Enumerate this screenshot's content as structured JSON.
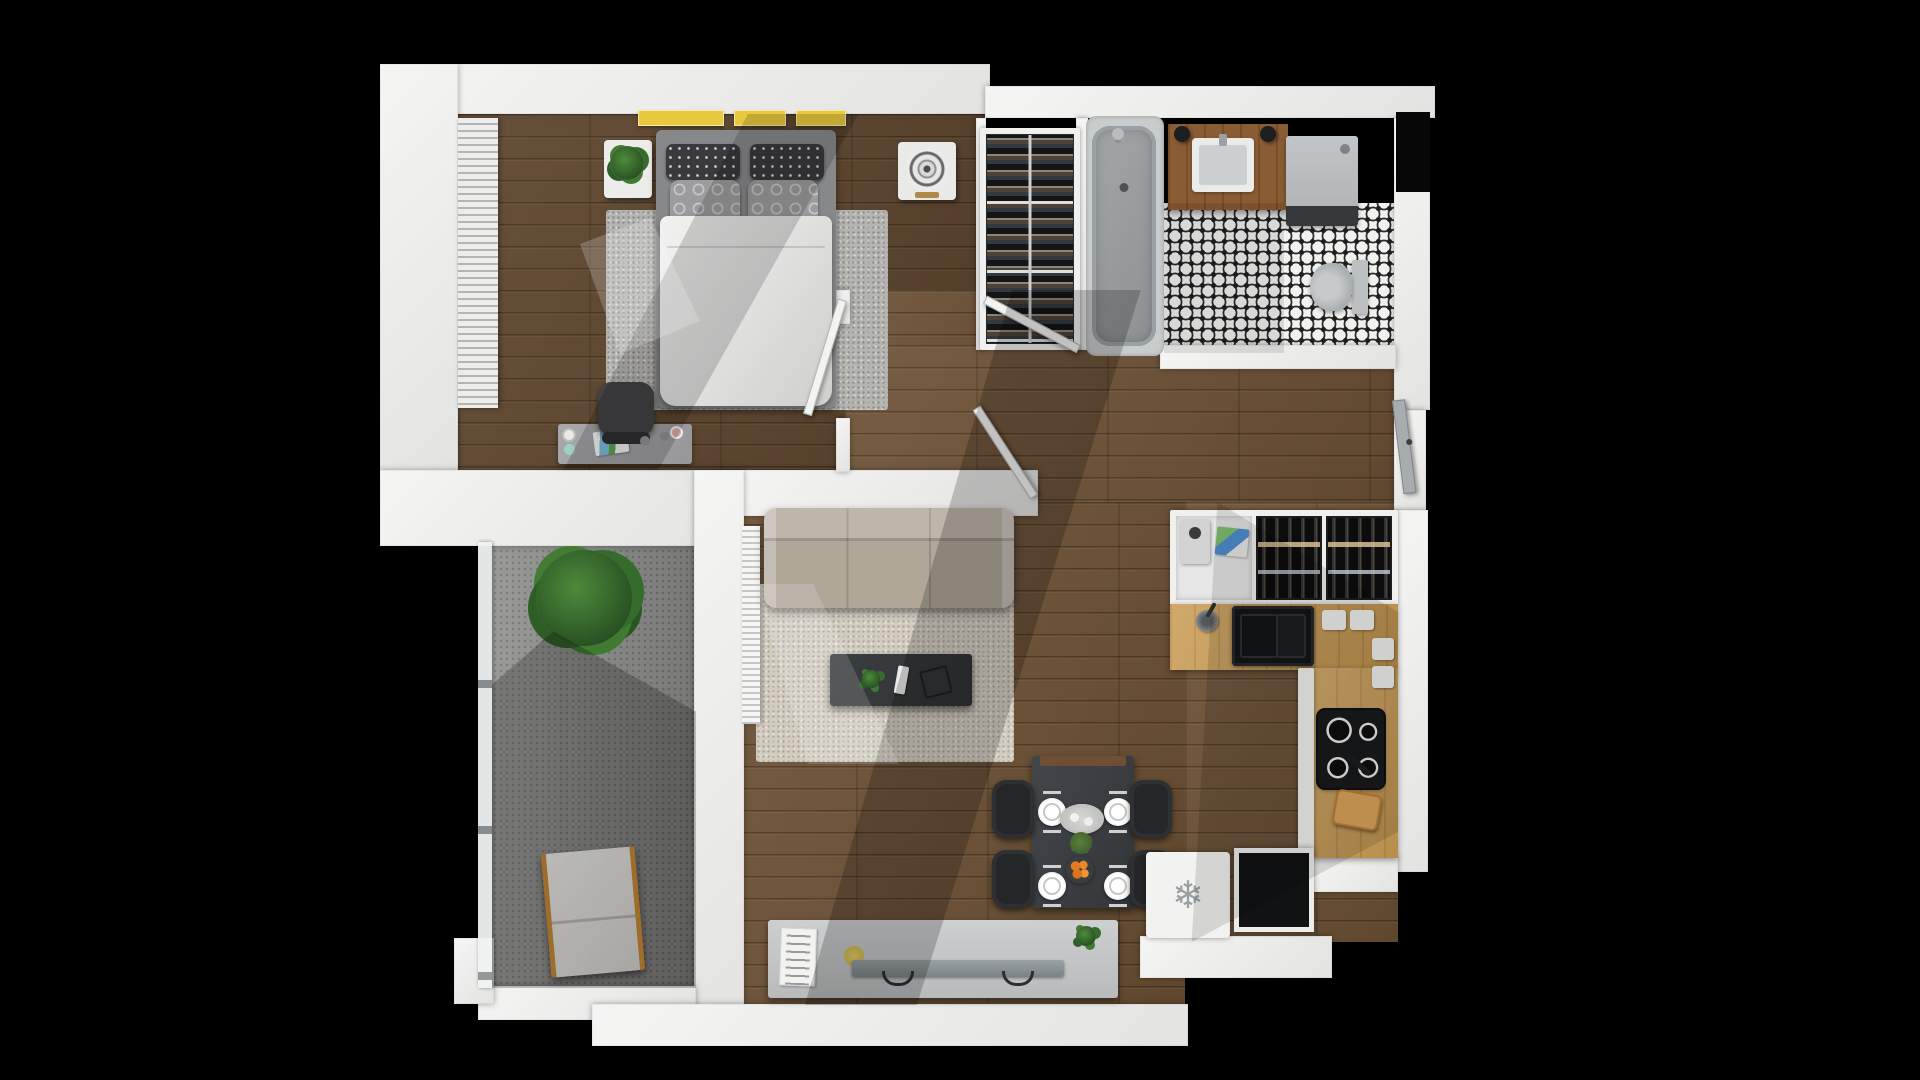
{
  "meta": {
    "title": "One-bedroom apartment 3D floor plan (top-down render)",
    "background": "#000000",
    "rooms": [
      "bedroom",
      "wardrobe-closet",
      "bathroom",
      "hallway",
      "kitchen",
      "living-room",
      "dining-area",
      "balcony"
    ]
  },
  "palette": {
    "wall": "#ececeb",
    "wood_floor": "#6d5135",
    "bedroom_floor": "#5c442c",
    "bedroom_rug": "#b5b4b1",
    "living_rug": "#d3cdc0",
    "sofa": "#aba293",
    "counter_oak": "#c89a52",
    "tile_white": "#f1f1ef",
    "tile_black": "#1f1f1f",
    "accent_yellow_books": "#e7c83e",
    "orange_fruit": "#e07b1f",
    "plant_green": "#2e5a26",
    "balcony_concrete": "#8f8f8d",
    "appliance_dark": "#111214"
  },
  "icons": {
    "freezer_snowflake": "❄"
  },
  "elements": [
    {
      "name": "floor-bedroom",
      "kind": "wood-dark",
      "x": 458,
      "y": 114,
      "w": 527,
      "h": 356
    },
    {
      "name": "floor-hall-upper",
      "kind": "wood",
      "x": 845,
      "y": 290,
      "w": 240,
      "h": 60
    },
    {
      "name": "floor-hallway",
      "kind": "wood",
      "x": 845,
      "y": 345,
      "w": 553,
      "h": 160
    },
    {
      "name": "floor-living",
      "kind": "wood",
      "x": 725,
      "y": 502,
      "w": 460,
      "h": 503
    },
    {
      "name": "floor-kitchen",
      "kind": "wood",
      "x": 1185,
      "y": 502,
      "w": 213,
      "h": 440
    },
    {
      "name": "floor-bathroom-tile",
      "kind": "tile",
      "x": 1164,
      "y": 203,
      "w": 232,
      "h": 150
    },
    {
      "name": "floor-balcony",
      "kind": "concrete",
      "x": 492,
      "y": 542,
      "w": 204,
      "h": 446
    },
    {
      "name": "rug-bedroom",
      "kind": "rug-grey",
      "x": 606,
      "y": 210,
      "w": 282,
      "h": 200
    },
    {
      "name": "rug-living",
      "kind": "rug-cream",
      "x": 756,
      "y": 584,
      "w": 258,
      "h": 178
    },
    {
      "name": "wall-top-left",
      "kind": "wall",
      "x": 380,
      "y": 64,
      "w": 610,
      "h": 50
    },
    {
      "name": "wall-left-bedroom",
      "kind": "wall",
      "x": 380,
      "y": 64,
      "w": 78,
      "h": 408
    },
    {
      "name": "wall-top-right",
      "kind": "wall",
      "x": 985,
      "y": 86,
      "w": 450,
      "h": 32
    },
    {
      "name": "wall-right-upper",
      "kind": "wall",
      "x": 1394,
      "y": 118,
      "w": 36,
      "h": 292
    },
    {
      "name": "shaft-niche",
      "kind": "black-box",
      "x": 1396,
      "y": 112,
      "w": 34,
      "h": 80
    },
    {
      "name": "wall-right-entry",
      "kind": "wall",
      "x": 1394,
      "y": 410,
      "w": 32,
      "h": 100
    },
    {
      "name": "wall-right-kitchen",
      "kind": "wall",
      "x": 1396,
      "y": 510,
      "w": 32,
      "h": 362
    },
    {
      "name": "wall-closet-left",
      "kind": "wall",
      "x": 976,
      "y": 118,
      "w": 10,
      "h": 232
    },
    {
      "name": "wall-closet-right",
      "kind": "wall",
      "x": 1076,
      "y": 118,
      "w": 12,
      "h": 232
    },
    {
      "name": "wall-bedroom-bottom",
      "kind": "wall",
      "x": 380,
      "y": 470,
      "w": 346,
      "h": 76
    },
    {
      "name": "wall-living-top",
      "kind": "wall",
      "x": 726,
      "y": 470,
      "w": 312,
      "h": 46
    },
    {
      "name": "wall-stub-bedroom-door",
      "kind": "wall",
      "x": 836,
      "y": 290,
      "w": 14,
      "h": 34
    },
    {
      "name": "wall-stub-bedroom-door-lower",
      "kind": "wall",
      "x": 836,
      "y": 418,
      "w": 14,
      "h": 54
    },
    {
      "name": "wall-bathroom-bottom",
      "kind": "wall",
      "x": 1160,
      "y": 345,
      "w": 236,
      "h": 24
    },
    {
      "name": "wall-balcony-divider",
      "kind": "wall",
      "x": 694,
      "y": 470,
      "w": 50,
      "h": 550
    },
    {
      "name": "wall-balcony-bottom",
      "kind": "wall",
      "x": 478,
      "y": 986,
      "w": 218,
      "h": 34
    },
    {
      "name": "wall-living-bottom",
      "kind": "wall",
      "x": 592,
      "y": 1004,
      "w": 596,
      "h": 42
    },
    {
      "name": "wall-bottom-right-step",
      "kind": "wall",
      "x": 1140,
      "y": 936,
      "w": 192,
      "h": 42
    },
    {
      "name": "wall-bottom-right-corner",
      "kind": "wall",
      "x": 1314,
      "y": 856,
      "w": 84,
      "h": 36
    },
    {
      "name": "wall-balcony-sill",
      "kind": "wall",
      "x": 454,
      "y": 938,
      "w": 40,
      "h": 66
    },
    {
      "name": "window-blinds-bedroom",
      "kind": "blinds",
      "x": 458,
      "y": 118,
      "w": 40,
      "h": 290
    },
    {
      "name": "nightstand-left",
      "kind": "nightstand",
      "x": 604,
      "y": 140,
      "w": 48,
      "h": 58
    },
    {
      "name": "nightstand-plant",
      "kind": "plant",
      "x": 610,
      "y": 146,
      "w": 34,
      "h": 34
    },
    {
      "name": "shelf-books-1",
      "kind": "book-yellow",
      "x": 638,
      "y": 110,
      "w": 86,
      "h": 16
    },
    {
      "name": "shelf-books-2",
      "kind": "book-yellow",
      "x": 734,
      "y": 110,
      "w": 52,
      "h": 16
    },
    {
      "name": "shelf-books-3",
      "kind": "book-yellow",
      "x": 796,
      "y": 110,
      "w": 50,
      "h": 16
    },
    {
      "name": "bed-frame",
      "kind": "bed-frame",
      "x": 656,
      "y": 130,
      "w": 180,
      "h": 278
    },
    {
      "name": "pillow-dark-left",
      "kind": "pillow-dark",
      "x": 666,
      "y": 144,
      "w": 74,
      "h": 36
    },
    {
      "name": "pillow-dark-right",
      "kind": "pillow-dark",
      "x": 750,
      "y": 144,
      "w": 74,
      "h": 36
    },
    {
      "name": "pillow-grey-left",
      "kind": "pillow-grey",
      "x": 670,
      "y": 180,
      "w": 70,
      "h": 46
    },
    {
      "name": "pillow-grey-right",
      "kind": "pillow-grey",
      "x": 748,
      "y": 180,
      "w": 70,
      "h": 46
    },
    {
      "name": "bed-duvet",
      "kind": "duvet",
      "x": 660,
      "y": 216,
      "w": 172,
      "h": 190
    },
    {
      "name": "nightstand-fan",
      "kind": "fan-unit",
      "x": 898,
      "y": 142,
      "w": 58,
      "h": 58
    },
    {
      "name": "desk",
      "kind": "desk",
      "x": 558,
      "y": 424,
      "w": 134,
      "h": 40
    },
    {
      "name": "desk-papers",
      "kind": "desk-papers",
      "x": 594,
      "y": 430,
      "w": 34,
      "h": 24,
      "r": -8
    },
    {
      "name": "office-chair",
      "kind": "chair-office",
      "x": 598,
      "y": 382,
      "w": 56,
      "h": 54
    },
    {
      "name": "desk-knob-1",
      "kind": "knob",
      "x": 640,
      "y": 436,
      "w": 10,
      "h": 10
    },
    {
      "name": "desk-knob-2",
      "kind": "knob",
      "x": 660,
      "y": 432,
      "w": 9,
      "h": 9
    },
    {
      "name": "desk-knob-3",
      "kind": "knob-pink",
      "x": 672,
      "y": 428,
      "w": 9,
      "h": 9
    },
    {
      "name": "desk-disc-1",
      "kind": "disc-white",
      "x": 562,
      "y": 428,
      "w": 14,
      "h": 14
    },
    {
      "name": "desk-disc-2",
      "kind": "disc-teal",
      "x": 564,
      "y": 444,
      "w": 11,
      "h": 11
    },
    {
      "name": "wardrobe-frame",
      "kind": "frame-white",
      "x": 980,
      "y": 128,
      "w": 100,
      "h": 222
    },
    {
      "name": "wardrobe-rack",
      "kind": "closet-rack",
      "x": 986,
      "y": 134,
      "w": 88,
      "h": 210
    },
    {
      "name": "bathtub-surround",
      "kind": "tub-surround",
      "x": 1086,
      "y": 116,
      "w": 78,
      "h": 240
    },
    {
      "name": "bathtub",
      "kind": "tub",
      "x": 1092,
      "y": 126,
      "w": 64,
      "h": 220
    },
    {
      "name": "bath-faucet",
      "kind": "faucet-dot",
      "x": 1112,
      "y": 128,
      "w": 12,
      "h": 12
    },
    {
      "name": "vanity",
      "kind": "vanity-wood",
      "x": 1168,
      "y": 124,
      "w": 120,
      "h": 86
    },
    {
      "name": "bath-sink",
      "kind": "sink-white",
      "x": 1192,
      "y": 138,
      "w": 62,
      "h": 54
    },
    {
      "name": "sconce-left",
      "kind": "sconce",
      "x": 1174,
      "y": 126,
      "w": 16,
      "h": 16
    },
    {
      "name": "sconce-right",
      "kind": "sconce",
      "x": 1260,
      "y": 126,
      "w": 16,
      "h": 16
    },
    {
      "name": "washer",
      "kind": "washer",
      "x": 1286,
      "y": 136,
      "w": 72,
      "h": 90
    },
    {
      "name": "toilet",
      "kind": "toilet",
      "x": 1310,
      "y": 260,
      "w": 58,
      "h": 54
    },
    {
      "name": "kitchen-upper-unit",
      "kind": "frame-white",
      "x": 1170,
      "y": 510,
      "w": 228,
      "h": 96
    },
    {
      "name": "appliance-nook",
      "kind": "appliance-nook",
      "x": 1176,
      "y": 516,
      "w": 76,
      "h": 84
    },
    {
      "name": "espresso-machine",
      "kind": "espresso",
      "x": 1180,
      "y": 520,
      "w": 30,
      "h": 44
    },
    {
      "name": "recipe-card",
      "kind": "card-color",
      "x": 1216,
      "y": 528,
      "w": 32,
      "h": 28,
      "r": 6
    },
    {
      "name": "wine-rack-left",
      "kind": "wine-rack",
      "x": 1256,
      "y": 516,
      "w": 66,
      "h": 84
    },
    {
      "name": "wine-rack-right",
      "kind": "wine-rack",
      "x": 1326,
      "y": 516,
      "w": 66,
      "h": 84
    },
    {
      "name": "counter-sink-run",
      "kind": "counter-oak",
      "x": 1170,
      "y": 604,
      "w": 228,
      "h": 66
    },
    {
      "name": "kitchen-faucet",
      "kind": "faucet-kitchen",
      "x": 1196,
      "y": 610,
      "w": 22,
      "h": 22
    },
    {
      "name": "kitchen-sink",
      "kind": "sink-black",
      "x": 1232,
      "y": 606,
      "w": 82,
      "h": 60
    },
    {
      "name": "trivet-1",
      "kind": "trivet",
      "x": 1322,
      "y": 610,
      "w": 24,
      "h": 20
    },
    {
      "name": "trivet-2",
      "kind": "trivet",
      "x": 1350,
      "y": 610,
      "w": 24,
      "h": 20
    },
    {
      "name": "counter-right-run",
      "kind": "counter-oak",
      "x": 1312,
      "y": 668,
      "w": 86,
      "h": 190
    },
    {
      "name": "cabinet-strip",
      "kind": "frame-white",
      "x": 1298,
      "y": 668,
      "w": 16,
      "h": 190
    },
    {
      "name": "trivet-3",
      "kind": "trivet",
      "x": 1372,
      "y": 638,
      "w": 22,
      "h": 22
    },
    {
      "name": "trivet-4",
      "kind": "trivet",
      "x": 1372,
      "y": 666,
      "w": 22,
      "h": 22
    },
    {
      "name": "cooktop",
      "kind": "cooktop",
      "x": 1318,
      "y": 710,
      "w": 66,
      "h": 78
    },
    {
      "name": "pan-handle",
      "kind": "pan-handle",
      "x": 1344,
      "y": 762,
      "w": 30,
      "h": 6,
      "r": 40
    },
    {
      "name": "cutting-board",
      "kind": "cutting-board",
      "x": 1334,
      "y": 792,
      "w": 46,
      "h": 36,
      "r": 10
    },
    {
      "name": "radiator",
      "kind": "radiator",
      "x": 742,
      "y": 526,
      "w": 18,
      "h": 198
    },
    {
      "name": "sofa",
      "kind": "sofa",
      "x": 764,
      "y": 508,
      "w": 250,
      "h": 100
    },
    {
      "name": "coffee-table",
      "kind": "table-dark",
      "x": 830,
      "y": 654,
      "w": 142,
      "h": 52
    },
    {
      "name": "coffee-table-plant",
      "kind": "plant-small",
      "x": 862,
      "y": 670,
      "w": 18,
      "h": 18
    },
    {
      "name": "coffee-table-remote",
      "kind": "remote",
      "x": 896,
      "y": 666,
      "w": 11,
      "h": 28,
      "r": 10
    },
    {
      "name": "coffee-table-book",
      "kind": "book-dark",
      "x": 922,
      "y": 668,
      "w": 28,
      "h": 28,
      "r": -14
    },
    {
      "name": "tv-console",
      "kind": "console",
      "x": 768,
      "y": 920,
      "w": 350,
      "h": 78
    },
    {
      "name": "console-poster",
      "kind": "poster",
      "x": 780,
      "y": 928,
      "w": 36,
      "h": 58,
      "r": 2
    },
    {
      "name": "console-disc",
      "kind": "disc-yellow",
      "x": 844,
      "y": 946,
      "w": 20,
      "h": 20
    },
    {
      "name": "tv-screen",
      "kind": "tv",
      "x": 852,
      "y": 960,
      "w": 212,
      "h": 16
    },
    {
      "name": "console-plant",
      "kind": "plant-small",
      "x": 1076,
      "y": 926,
      "w": 20,
      "h": 20
    },
    {
      "name": "dining-table",
      "kind": "table-dark2",
      "x": 1032,
      "y": 756,
      "w": 102,
      "h": 152
    },
    {
      "name": "dining-runner",
      "kind": "runner",
      "x": 1040,
      "y": 756,
      "w": 86,
      "h": 10
    },
    {
      "name": "plate-top-left",
      "kind": "plate",
      "x": 1038,
      "y": 798,
      "w": 28,
      "h": 28
    },
    {
      "name": "plate-top-right",
      "kind": "plate",
      "x": 1104,
      "y": 798,
      "w": 28,
      "h": 28
    },
    {
      "name": "plate-bottom-left",
      "kind": "plate",
      "x": 1038,
      "y": 872,
      "w": 28,
      "h": 28
    },
    {
      "name": "plate-bottom-right",
      "kind": "plate",
      "x": 1104,
      "y": 872,
      "w": 28,
      "h": 28
    },
    {
      "name": "serving-platter",
      "kind": "platter",
      "x": 1060,
      "y": 804,
      "w": 44,
      "h": 30
    },
    {
      "name": "table-flowers",
      "kind": "flowers",
      "x": 1070,
      "y": 832,
      "w": 22,
      "h": 22
    },
    {
      "name": "oranges-plate",
      "kind": "oranges",
      "x": 1066,
      "y": 856,
      "w": 28,
      "h": 28
    },
    {
      "name": "dining-chair-1",
      "kind": "chair-dining",
      "x": 992,
      "y": 780,
      "w": 42,
      "h": 58
    },
    {
      "name": "dining-chair-2",
      "kind": "chair-dining",
      "x": 1130,
      "y": 780,
      "w": 42,
      "h": 58
    },
    {
      "name": "dining-chair-3",
      "kind": "chair-dining",
      "x": 992,
      "y": 850,
      "w": 42,
      "h": 58
    },
    {
      "name": "dining-chair-4",
      "kind": "chair-dining",
      "x": 1130,
      "y": 850,
      "w": 42,
      "h": 58
    },
    {
      "name": "freezer-box",
      "kind": "fridge",
      "x": 1146,
      "y": 852,
      "w": 84,
      "h": 86,
      "glyph": "❄"
    },
    {
      "name": "dark-appliance",
      "kind": "dark-box",
      "x": 1234,
      "y": 848,
      "w": 80,
      "h": 84
    },
    {
      "name": "balcony-glass-wall",
      "kind": "glass",
      "x": 478,
      "y": 542,
      "w": 14,
      "h": 446
    },
    {
      "name": "balcony-plant",
      "kind": "plant-big",
      "x": 536,
      "y": 550,
      "w": 96,
      "h": 96
    },
    {
      "name": "lounge-chair",
      "kind": "lounge",
      "x": 546,
      "y": 850,
      "w": 94,
      "h": 124,
      "r": -5
    },
    {
      "name": "door-bedroom",
      "kind": "door-leaf",
      "x": 838,
      "y": 300,
      "w": 9,
      "h": 120,
      "r": 17,
      "origin": "top center"
    },
    {
      "name": "door-bathroom",
      "kind": "door-leaf",
      "x": 985,
      "y": 295,
      "w": 106,
      "h": 9,
      "r": 28,
      "origin": "left center"
    },
    {
      "name": "door-living",
      "kind": "door-leaf",
      "x": 972,
      "y": 408,
      "w": 9,
      "h": 106,
      "r": -33,
      "origin": "top center"
    },
    {
      "name": "door-entry",
      "kind": "door-entry",
      "x": 1392,
      "y": 400,
      "w": 13,
      "h": 94,
      "r": -7,
      "origin": "top center"
    },
    {
      "name": "shadow-bedroom",
      "kind": "overlay",
      "x": 458,
      "y": 114,
      "w": 527,
      "h": 356,
      "bg": "rgba(0,0,0,0.16)",
      "clip": "polygon(55% 0, 76% 0, 38% 100%, 20% 100%)"
    },
    {
      "name": "sunlight-bed",
      "kind": "overlay",
      "x": 560,
      "y": 200,
      "w": 200,
      "h": 220,
      "bg": "rgba(255,255,255,0.20)",
      "clip": "polygon(10% 20%, 45% 8%, 70% 55%, 30% 70%)"
    },
    {
      "name": "shadow-hall-living",
      "kind": "overlay",
      "x": 760,
      "y": 290,
      "w": 560,
      "h": 715,
      "bg": "rgba(0,0,0,0.20)",
      "clip": "polygon(45% 0, 68% 0, 28% 100%, 8% 100%)"
    },
    {
      "name": "shadow-kitchen",
      "kind": "overlay",
      "x": 1140,
      "y": 502,
      "w": 258,
      "h": 440,
      "bg": "rgba(0,0,0,0.12)",
      "clip": "polygon(30% 0, 100% 25%, 100% 75%, 20% 100%)"
    },
    {
      "name": "shadow-balcony",
      "kind": "overlay",
      "x": 492,
      "y": 542,
      "w": 204,
      "h": 446,
      "bg": "rgba(0,0,0,0.22)",
      "clip": "polygon(30% 20%, 100% 38%, 100% 100%, 0 100%, 0 32%)"
    },
    {
      "name": "shadow-bathroom",
      "kind": "overlay",
      "x": 1164,
      "y": 203,
      "w": 120,
      "h": 150,
      "bg": "rgba(0,0,0,0.10)"
    },
    {
      "name": "sunlight-living-rug",
      "kind": "overlay",
      "x": 756,
      "y": 584,
      "w": 260,
      "h": 180,
      "bg": "rgba(255,255,255,0.14)",
      "clip": "polygon(0 0, 22% 0, 55% 100%, 20% 100%)"
    }
  ]
}
